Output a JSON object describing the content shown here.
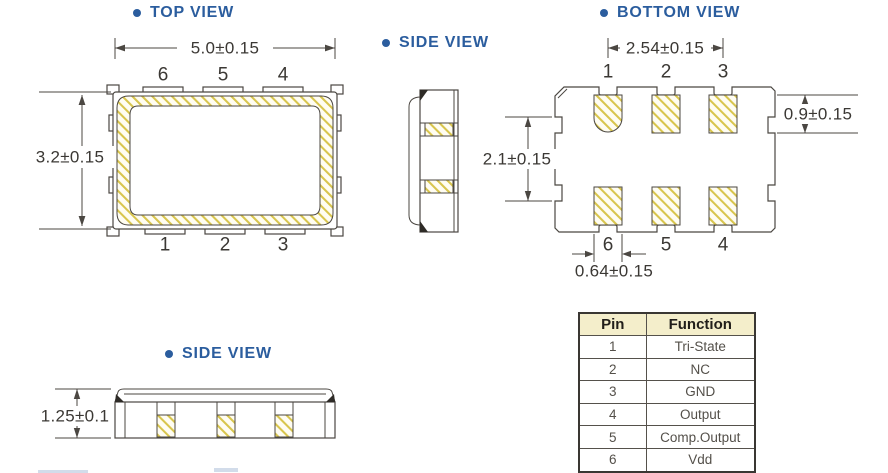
{
  "titles": {
    "top_view": "TOP VIEW",
    "side_view_top": "SIDE VIEW",
    "bottom_view": "BOTTOM VIEW",
    "side_view_bottom": "SIDE VIEW"
  },
  "top_view": {
    "width_dim": "5.0±0.15",
    "height_dim": "3.2±0.15",
    "top_pins": [
      "6",
      "5",
      "4"
    ],
    "bottom_pins": [
      "1",
      "2",
      "3"
    ]
  },
  "bottom_view": {
    "pitch_dim": "2.54±0.15",
    "pad_height_dim": "0.9±0.15",
    "inner_height_dim": "2.1±0.15",
    "pad_width_dim": "0.64±0.15",
    "top_pins": [
      "1",
      "2",
      "3"
    ],
    "bottom_pins": [
      "6",
      "5",
      "4"
    ]
  },
  "side_view_bottom": {
    "height_dim": "1.25±0.1"
  },
  "pin_table": {
    "headers": [
      "Pin",
      "Function"
    ],
    "rows": [
      {
        "pin": "1",
        "function": "Tri-State"
      },
      {
        "pin": "2",
        "function": "NC"
      },
      {
        "pin": "3",
        "function": "GND"
      },
      {
        "pin": "4",
        "function": "Output"
      },
      {
        "pin": "5",
        "function": "Comp.Output"
      },
      {
        "pin": "6",
        "function": "Vdd"
      }
    ]
  },
  "colors": {
    "title_blue": "#2b5d9e",
    "line": "#4b4742",
    "hatch_yellow": "#d8c54d",
    "table_header_bg": "#f4eecb"
  }
}
